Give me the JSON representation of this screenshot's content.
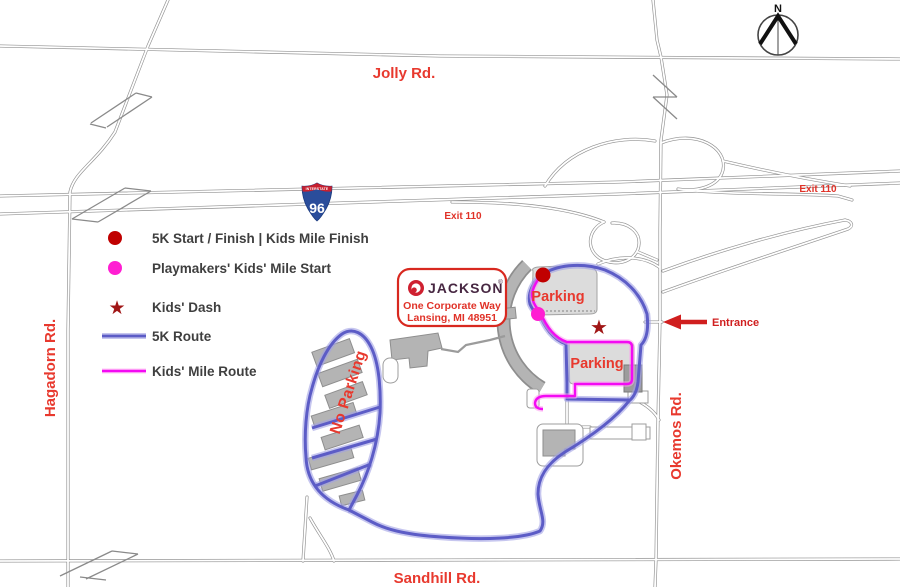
{
  "map_labels": {
    "roads": {
      "jolly": "Jolly Rd.",
      "sandhill": "Sandhill Rd.",
      "hagadorn": "Hagadorn Rd.",
      "okemos": "Okemos Rd."
    },
    "highway": {
      "shield_top": "INTERSTATE",
      "shield_number": "96",
      "exit_label": "Exit 110"
    },
    "annotations": {
      "entrance": "Entrance",
      "parking": "Parking",
      "no_parking": "No Parking",
      "compass_north": "N"
    }
  },
  "legend": {
    "items": [
      {
        "id": "start-finish",
        "marker": "red-dot",
        "label": "5K Start / Finish | Kids Mile Finish"
      },
      {
        "id": "kids-mile-start",
        "marker": "magenta-dot",
        "label": "Playmakers' Kids' Mile Start"
      },
      {
        "id": "kids-dash",
        "marker": "red-star",
        "label": "Kids' Dash"
      },
      {
        "id": "route-5k",
        "marker": "blue-line",
        "label": "5K Route"
      },
      {
        "id": "route-kids-mile",
        "marker": "magenta-line",
        "label": "Kids' Mile Route"
      }
    ]
  },
  "venue": {
    "brand": "JACKSON",
    "trademark": "®",
    "address_line1": "One Corporate Way",
    "address_line2": "Lansing, MI 48951"
  },
  "icons": {
    "star": "★"
  },
  "colors": {
    "label_red": "#e8392e",
    "route_5k_blue": "#5c5cc6",
    "route_kids_magenta": "#f30af3",
    "start_dot_red": "#c00000",
    "kids_start_magenta": "#ff1ed2",
    "star_dark_red": "#a01616",
    "shield_blue": "#2a4d9b",
    "shield_red": "#c8202f",
    "building_gray": "#b4b4b4",
    "parking_gray": "#dcdcdc"
  }
}
